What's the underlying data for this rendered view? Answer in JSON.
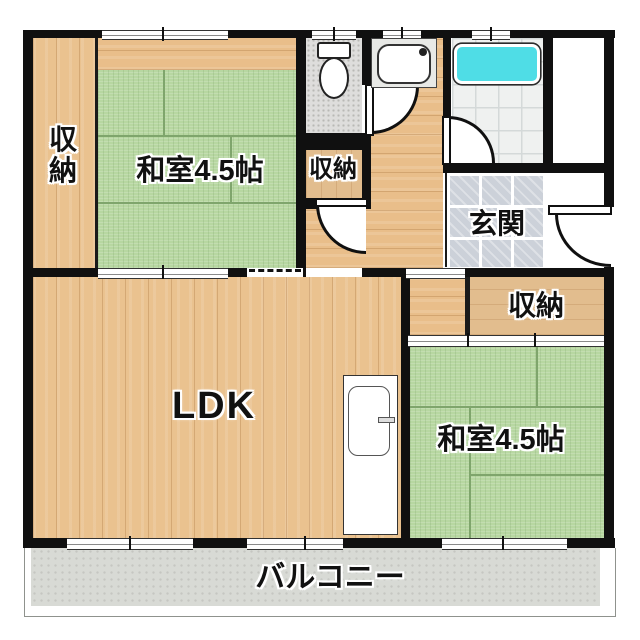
{
  "plan": {
    "rooms": {
      "storage_left": {
        "label": "収納"
      },
      "washitsu_top": {
        "label": "和室4.5帖"
      },
      "storage_middle": {
        "label": "収納"
      },
      "genkan": {
        "label": "玄関"
      },
      "storage_right": {
        "label": "収納"
      },
      "ldk": {
        "label": "LDK"
      },
      "washitsu_bottom": {
        "label": "和室4.5帖"
      },
      "balcony": {
        "label": "バルコニー"
      }
    },
    "fixtures": [
      "toilet",
      "washbasin",
      "bathtub",
      "kitchen-unit"
    ],
    "colors": {
      "wall": "#101010",
      "tatami": "#b7d7a1",
      "wood_floor": "#eac28f",
      "closet_floor": "#e2bd8e",
      "bathtub": "#4fdde6",
      "entrance_tile": "#ccd1d9",
      "bath_tile": "#eff1f0",
      "toilet_floor": "#dedddc",
      "balcony_floor": "#d8dad5"
    }
  }
}
